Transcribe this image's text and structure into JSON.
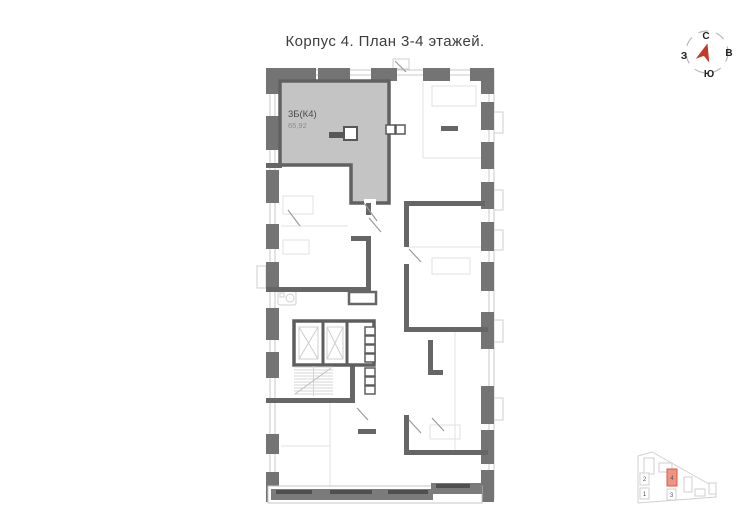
{
  "title": "Корпус 4. План 3-4 этажей.",
  "apartment": {
    "type_label": "3Б(К4)",
    "area": "65,92"
  },
  "compass": {
    "n": "С",
    "e": "В",
    "s": "Ю",
    "w": "З"
  },
  "minimap": {
    "buildings": [
      {
        "num": "1",
        "highlighted": false
      },
      {
        "num": "2",
        "highlighted": false
      },
      {
        "num": "3",
        "highlighted": false
      },
      {
        "num": "4",
        "highlighted": true
      }
    ]
  },
  "colors": {
    "wall_dark": "#6e6e6e",
    "apartment_fill": "#c4c4c4",
    "compass_north_blue": "#2b59c8",
    "compass_arrow_red": "#c23b2a",
    "minimap_highlight_fill": "#ef9382",
    "minimap_highlight_border": "#d65b45",
    "minimap_highlight_num": "#b03a2a"
  }
}
